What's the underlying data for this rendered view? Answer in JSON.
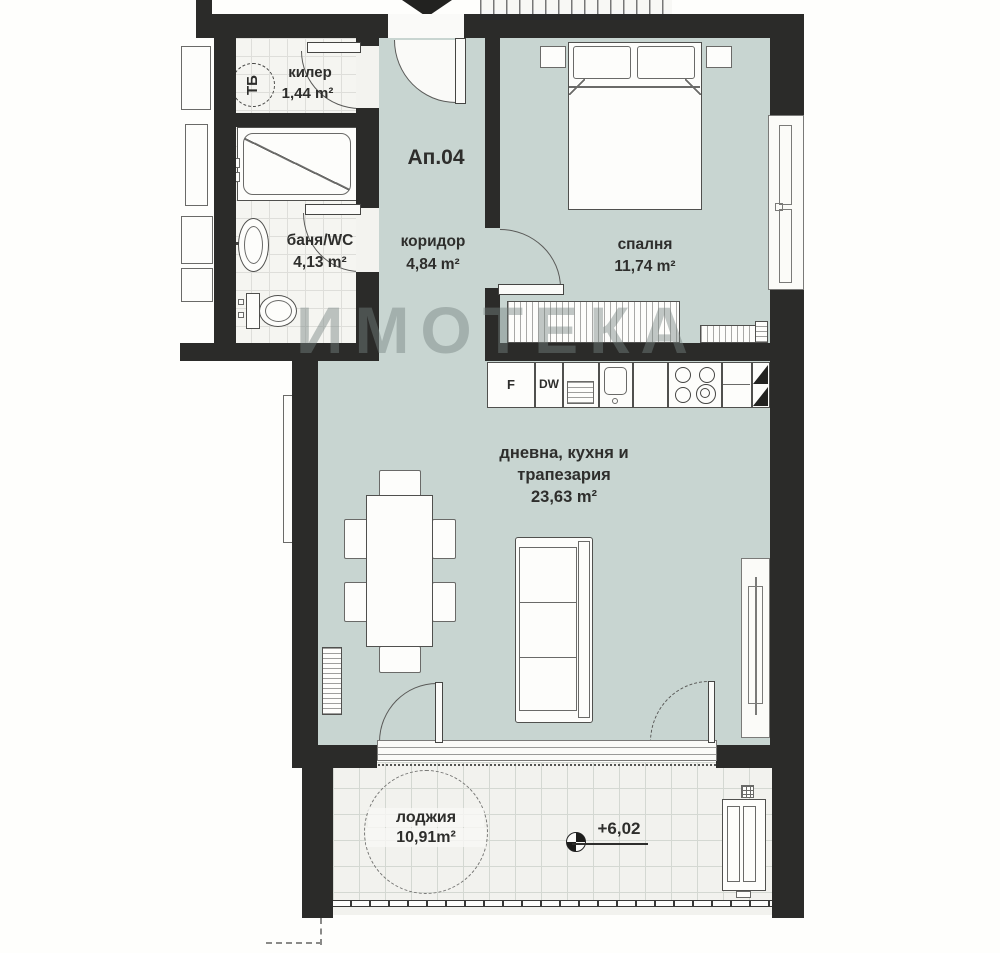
{
  "plan": {
    "apartment_label": "Ап.04",
    "watermark": "ИМОТЕКА",
    "elevation_label": "+6,02",
    "chute_label": "ТБ",
    "rooms": [
      {
        "name": "килер",
        "area": "1,44 m²"
      },
      {
        "name": "баня/WC",
        "area": "4,13 m²"
      },
      {
        "name": "коридор",
        "area": "4,84 m²"
      },
      {
        "name": "спалня",
        "area": "11,74 m²"
      },
      {
        "name": "дневна, кухня и",
        "name2": "трапезария",
        "area": "23,63 m²"
      },
      {
        "name": "лоджия",
        "area": "10,91m²"
      }
    ],
    "kitchen": {
      "fridge": "F",
      "dishwasher": "DW"
    },
    "colors": {
      "wall": "#2b2b29",
      "room_fill": "#c8d5d1",
      "tile_fill": "#f5f5f1"
    }
  }
}
